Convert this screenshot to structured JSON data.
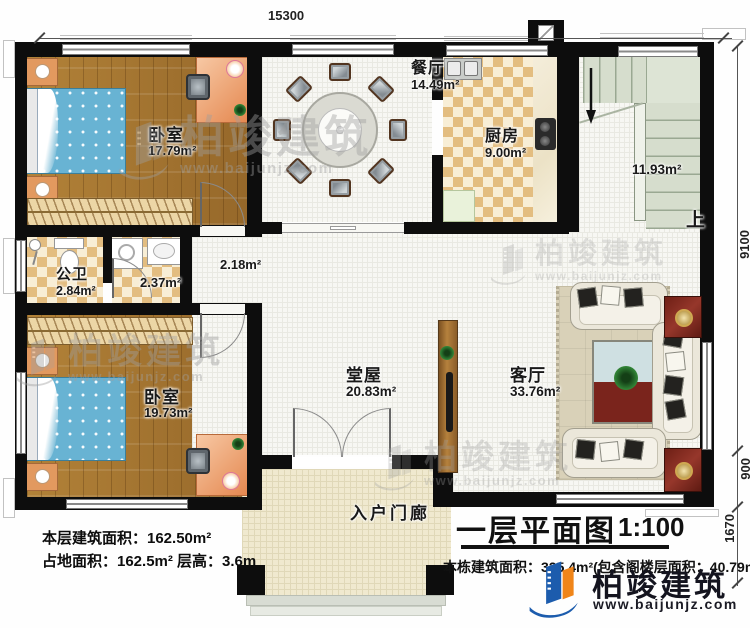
{
  "plan": {
    "dimensions": {
      "top_width": "15300",
      "right_upper": "9100",
      "right_mid": "900",
      "right_lower": "1670"
    },
    "rooms": {
      "bedroom_top": {
        "name": "卧室",
        "area": "17.79m²"
      },
      "bedroom_bottom": {
        "name": "卧室",
        "area": "19.73m²"
      },
      "dining": {
        "name": "餐厅",
        "area": "14.49m²"
      },
      "kitchen": {
        "name": "厨房",
        "area": "9.00m²"
      },
      "bathroom": {
        "name": "公卫",
        "area": "2.84m²"
      },
      "laundry": {
        "area": "2.37m²"
      },
      "hallway": {
        "area": "2.18m²"
      },
      "stairwell": {
        "area": "11.93m²",
        "direction": "上"
      },
      "hall": {
        "name": "堂屋",
        "area": "20.83m²"
      },
      "living": {
        "name": "客厅",
        "area": "33.76m²"
      },
      "porch": {
        "name": "入户门廊"
      }
    }
  },
  "title_block": {
    "title": "一层平面图",
    "scale": "1:100",
    "total_area": "本栋建筑面积：325.4m²(包含阁楼层面积：40.79m²)"
  },
  "stats": {
    "line1": "本层建筑面积：162.50m²",
    "line2": "占地面积：162.5m² 层高：3.6m"
  },
  "brand": {
    "name": "柏竣建筑",
    "website": "www.baijunjz.com"
  }
}
